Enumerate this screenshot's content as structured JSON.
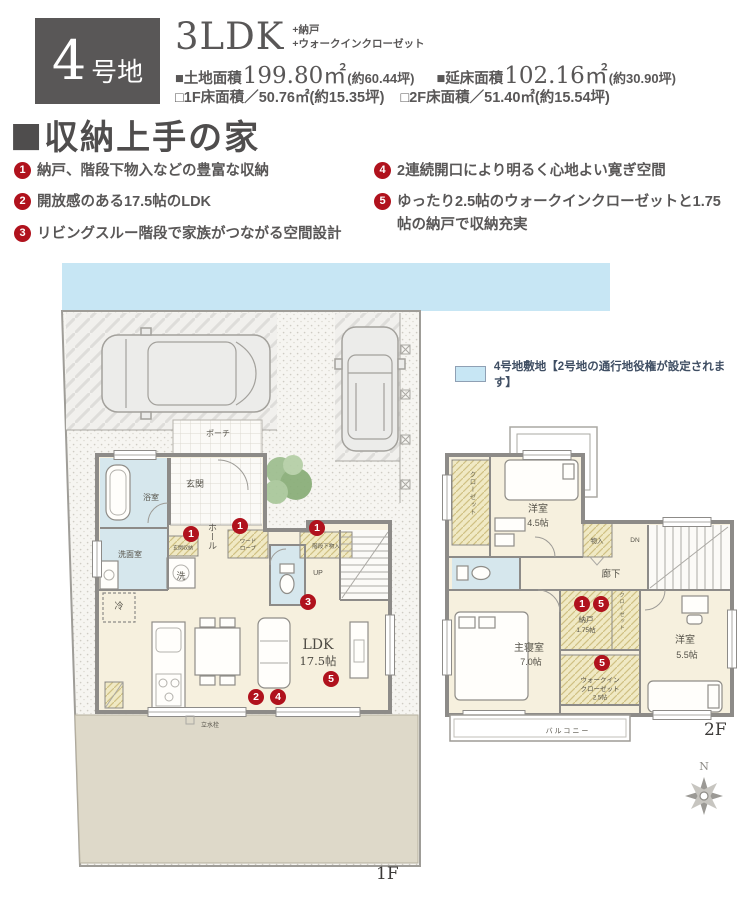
{
  "header": {
    "lot_number": "4",
    "lot_suffix": "号地",
    "plan_type": "3LDK",
    "extra1": "+納戸",
    "extra2": "+ウォークインクローゼット",
    "area1_label": "■土地面積",
    "area1_value": "199.80㎡",
    "area1_note": "(約60.44坪)",
    "area2_label": "■延床面積",
    "area2_value": "102.16㎡",
    "area2_note": "(約30.90坪)",
    "area3_label": "□1F床面積／",
    "area3_value": "50.76㎡",
    "area3_note": "(約15.35坪)",
    "area4_label": "□2F床面積／",
    "area4_value": "51.40㎡",
    "area4_note": "(約15.54坪)"
  },
  "headline": {
    "marker": "■",
    "text": "収納上手の家"
  },
  "features": {
    "items": [
      {
        "num": "1",
        "text": "納戸、階段下物入などの豊富な収納"
      },
      {
        "num": "2",
        "text": "開放感のある17.5帖のLDK"
      },
      {
        "num": "3",
        "text": "リビングスルー階段で家族がつながる空間設計"
      },
      {
        "num": "4",
        "text": "2連続開口により明るく心地よい寛ぎ空間"
      },
      {
        "num": "5",
        "text": "ゆったり2.5帖のウォークインクローゼットと1.75帖の納戸で収納充実"
      }
    ]
  },
  "legend": {
    "text": "4号地敷地【2号地の通行地役権が設定されます】"
  },
  "badges": {
    "n1": "1",
    "n2": "2",
    "n3": "3",
    "n4": "4",
    "n5": "5"
  },
  "plan1f": {
    "floor_label": "1F",
    "rooms": {
      "porch": "ポーチ",
      "bath": "浴室",
      "wash": "洗面室",
      "washer": "洗",
      "entrance": "玄関",
      "hall": "ホール",
      "shoe_storage": "玄関収納",
      "wardrobe1": "ワード",
      "wardrobe2": "ローブ",
      "under_stairs": "階段下物入",
      "up": "UP",
      "fridge": "冷",
      "ldk": "LDK",
      "ldk_size": "17.5帖",
      "faucet": "立水栓"
    }
  },
  "plan2f": {
    "floor_label": "2F",
    "rooms": {
      "room45": "洋室",
      "room45_size": "4.5帖",
      "closet_left": "クローゼット",
      "storage": "物入",
      "dn": "DN",
      "corridor": "廊下",
      "master": "主寝室",
      "master_size": "7.0帖",
      "nando": "納戸",
      "nando_size": "1.75帖",
      "closet_mid": "クローゼット",
      "wic1": "ウォークイン",
      "wic2": "クローゼット",
      "wic_size": "2.5帖",
      "room55": "洋室",
      "room55_size": "5.5帖",
      "balcony": "バルコニー"
    }
  },
  "compass": {
    "north": "N"
  },
  "colors": {
    "accent_red": "#b0121d",
    "band_blue": "#c7e6f4",
    "dark_gray": "#595757",
    "cream": "#f6f0de",
    "room_blue": "#d6e7ed",
    "storage_yellow": "#f0e9c4",
    "yard_beige": "#ded9c9"
  }
}
